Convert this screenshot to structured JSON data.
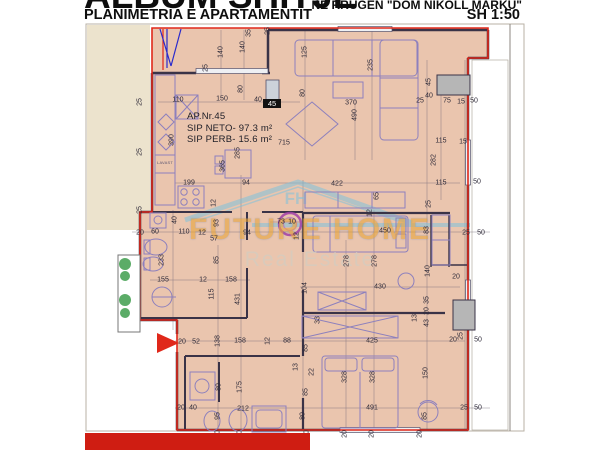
{
  "header": {
    "title": "ALBUM SHITJE",
    "subtitle": "PLANIMETRIA E APARTAMENTIT",
    "address": "NE RRUGEN \"DOM NIKOLL MARKU\"",
    "scale": "SH 1:50"
  },
  "apartment": {
    "number_label": "AP.Nr.45",
    "net_area": "SIP NETO- 97.3 m²",
    "common_area": "SIP PERB- 15.6 m²",
    "unit_marker": "45",
    "kitchen_appliance_label": "LAVAST"
  },
  "watermark": {
    "brand": "FUTURE HOME",
    "tagline": "Real Estate",
    "initials": "FH"
  },
  "colors": {
    "boundary_red": "#e0281a",
    "floor_peach": "#eac5ae",
    "exterior_cream": "#ece3cd",
    "wall_dark": "#3a3347",
    "furniture_purple": "#8d80bd",
    "watermark_orange": "#e8a43c",
    "watermark_blue": "#7fc2dc",
    "plant_green": "#3f9e4d",
    "accent_gray": "#b6b6b6",
    "bottom_bar_red": "#cf1d12"
  },
  "dimensions": [
    {
      "t": "140",
      "x": 221,
      "y": 52,
      "r": 1
    },
    {
      "t": "140",
      "x": 243,
      "y": 47,
      "r": 1
    },
    {
      "t": "35",
      "x": 249,
      "y": 33,
      "r": 1
    },
    {
      "t": "25",
      "x": 206,
      "y": 68,
      "r": 1
    },
    {
      "t": "80",
      "x": 241,
      "y": 89,
      "r": 1
    },
    {
      "t": "110",
      "x": 178,
      "y": 100,
      "r": 0
    },
    {
      "t": "150",
      "x": 222,
      "y": 99,
      "r": 0
    },
    {
      "t": "40",
      "x": 258,
      "y": 100,
      "r": 0
    },
    {
      "t": "370",
      "x": 351,
      "y": 103,
      "r": 0
    },
    {
      "t": "490",
      "x": 355,
      "y": 115,
      "r": 1
    },
    {
      "t": "25",
      "x": 268,
      "y": 31,
      "r": 1
    },
    {
      "t": "125",
      "x": 305,
      "y": 52,
      "r": 1
    },
    {
      "t": "80",
      "x": 303,
      "y": 93,
      "r": 1
    },
    {
      "t": "235",
      "x": 371,
      "y": 65,
      "r": 1
    },
    {
      "t": "25",
      "x": 420,
      "y": 101,
      "r": 0
    },
    {
      "t": "40",
      "x": 429,
      "y": 96,
      "r": 0
    },
    {
      "t": "45",
      "x": 429,
      "y": 82,
      "r": 1
    },
    {
      "t": "75",
      "x": 447,
      "y": 101,
      "r": 0
    },
    {
      "t": "15",
      "x": 461,
      "y": 102,
      "r": 0
    },
    {
      "t": "50",
      "x": 474,
      "y": 101,
      "r": 0
    },
    {
      "t": "115",
      "x": 441,
      "y": 141,
      "r": 0
    },
    {
      "t": "15",
      "x": 463,
      "y": 142,
      "r": 0
    },
    {
      "t": "282",
      "x": 434,
      "y": 160,
      "r": 1
    },
    {
      "t": "115",
      "x": 441,
      "y": 183,
      "r": 0
    },
    {
      "t": "50",
      "x": 477,
      "y": 182,
      "r": 0
    },
    {
      "t": "390",
      "x": 172,
      "y": 140,
      "r": 1
    },
    {
      "t": "285",
      "x": 238,
      "y": 153,
      "r": 1
    },
    {
      "t": "365",
      "x": 223,
      "y": 166,
      "r": 1
    },
    {
      "t": "199",
      "x": 189,
      "y": 183,
      "r": 0
    },
    {
      "t": "94",
      "x": 246,
      "y": 183,
      "r": 0
    },
    {
      "t": "422",
      "x": 337,
      "y": 184,
      "r": 0
    },
    {
      "t": "65",
      "x": 377,
      "y": 196,
      "r": 1
    },
    {
      "t": "25",
      "x": 429,
      "y": 204,
      "r": 1
    },
    {
      "t": "12",
      "x": 214,
      "y": 203,
      "r": 1
    },
    {
      "t": "12",
      "x": 370,
      "y": 213,
      "r": 1
    },
    {
      "t": "93",
      "x": 217,
      "y": 223,
      "r": 1
    },
    {
      "t": "40",
      "x": 175,
      "y": 220,
      "r": 1
    },
    {
      "t": "20",
      "x": 140,
      "y": 233,
      "r": 0
    },
    {
      "t": "60",
      "x": 155,
      "y": 232,
      "r": 0
    },
    {
      "t": "110",
      "x": 184,
      "y": 232,
      "r": 0
    },
    {
      "t": "12",
      "x": 202,
      "y": 233,
      "r": 0
    },
    {
      "t": "57",
      "x": 214,
      "y": 239,
      "r": 0
    },
    {
      "t": "94",
      "x": 247,
      "y": 233,
      "r": 0
    },
    {
      "t": "73",
      "x": 281,
      "y": 222,
      "r": 0
    },
    {
      "t": "10",
      "x": 292,
      "y": 222,
      "r": 0
    },
    {
      "t": "12",
      "x": 297,
      "y": 236,
      "r": 1
    },
    {
      "t": "450",
      "x": 385,
      "y": 231,
      "r": 0
    },
    {
      "t": "83",
      "x": 427,
      "y": 230,
      "r": 1
    },
    {
      "t": "25",
      "x": 466,
      "y": 233,
      "r": 0
    },
    {
      "t": "50",
      "x": 481,
      "y": 233,
      "r": 0
    },
    {
      "t": "278",
      "x": 347,
      "y": 261,
      "r": 1
    },
    {
      "t": "278",
      "x": 375,
      "y": 261,
      "r": 1
    },
    {
      "t": "140",
      "x": 428,
      "y": 271,
      "r": 1
    },
    {
      "t": "104",
      "x": 305,
      "y": 288,
      "r": 1
    },
    {
      "t": "430",
      "x": 380,
      "y": 287,
      "r": 0
    },
    {
      "t": "20",
      "x": 456,
      "y": 277,
      "r": 0
    },
    {
      "t": "35",
      "x": 427,
      "y": 300,
      "r": 1
    },
    {
      "t": "20",
      "x": 427,
      "y": 311,
      "r": 1
    },
    {
      "t": "233",
      "x": 162,
      "y": 260,
      "r": 1
    },
    {
      "t": "85",
      "x": 217,
      "y": 260,
      "r": 1
    },
    {
      "t": "155",
      "x": 163,
      "y": 280,
      "r": 0
    },
    {
      "t": "12",
      "x": 203,
      "y": 280,
      "r": 0
    },
    {
      "t": "158",
      "x": 231,
      "y": 280,
      "r": 0
    },
    {
      "t": "115",
      "x": 212,
      "y": 294,
      "r": 1
    },
    {
      "t": "431",
      "x": 238,
      "y": 299,
      "r": 1
    },
    {
      "t": "33",
      "x": 318,
      "y": 320,
      "r": 1
    },
    {
      "t": "13",
      "x": 415,
      "y": 318,
      "r": 1
    },
    {
      "t": "43",
      "x": 427,
      "y": 323,
      "r": 1
    },
    {
      "t": "425",
      "x": 372,
      "y": 341,
      "r": 0
    },
    {
      "t": "20",
      "x": 453,
      "y": 340,
      "r": 0
    },
    {
      "t": "25",
      "x": 461,
      "y": 336,
      "r": 1
    },
    {
      "t": "50",
      "x": 478,
      "y": 340,
      "r": 0
    },
    {
      "t": "20",
      "x": 182,
      "y": 342,
      "r": 0
    },
    {
      "t": "52",
      "x": 196,
      "y": 342,
      "r": 0
    },
    {
      "t": "138",
      "x": 218,
      "y": 341,
      "r": 1
    },
    {
      "t": "158",
      "x": 240,
      "y": 341,
      "r": 0
    },
    {
      "t": "12",
      "x": 268,
      "y": 341,
      "r": 1
    },
    {
      "t": "88",
      "x": 287,
      "y": 341,
      "r": 0
    },
    {
      "t": "85",
      "x": 306,
      "y": 348,
      "r": 1
    },
    {
      "t": "13",
      "x": 296,
      "y": 367,
      "r": 1
    },
    {
      "t": "22",
      "x": 312,
      "y": 372,
      "r": 1
    },
    {
      "t": "80",
      "x": 219,
      "y": 387,
      "r": 1
    },
    {
      "t": "175",
      "x": 240,
      "y": 387,
      "r": 1
    },
    {
      "t": "328",
      "x": 345,
      "y": 377,
      "r": 1
    },
    {
      "t": "328",
      "x": 373,
      "y": 377,
      "r": 1
    },
    {
      "t": "150",
      "x": 426,
      "y": 373,
      "r": 1
    },
    {
      "t": "85",
      "x": 306,
      "y": 392,
      "r": 1
    },
    {
      "t": "20",
      "x": 181,
      "y": 408,
      "r": 0
    },
    {
      "t": "40",
      "x": 193,
      "y": 408,
      "r": 0
    },
    {
      "t": "212",
      "x": 243,
      "y": 409,
      "r": 0
    },
    {
      "t": "95",
      "x": 218,
      "y": 416,
      "r": 1
    },
    {
      "t": "80",
      "x": 303,
      "y": 416,
      "r": 1
    },
    {
      "t": "491",
      "x": 372,
      "y": 408,
      "r": 0
    },
    {
      "t": "85",
      "x": 425,
      "y": 416,
      "r": 1
    },
    {
      "t": "25",
      "x": 464,
      "y": 408,
      "r": 0
    },
    {
      "t": "50",
      "x": 478,
      "y": 408,
      "r": 0
    },
    {
      "t": "20",
      "x": 218,
      "y": 434,
      "r": 1
    },
    {
      "t": "20",
      "x": 240,
      "y": 434,
      "r": 1
    },
    {
      "t": "20",
      "x": 307,
      "y": 434,
      "r": 1
    },
    {
      "t": "20",
      "x": 345,
      "y": 434,
      "r": 1
    },
    {
      "t": "20",
      "x": 372,
      "y": 434,
      "r": 1
    },
    {
      "t": "20",
      "x": 420,
      "y": 434,
      "r": 1
    },
    {
      "t": "25",
      "x": 140,
      "y": 102,
      "r": 1
    },
    {
      "t": "25",
      "x": 140,
      "y": 152,
      "r": 1
    },
    {
      "t": "25",
      "x": 140,
      "y": 210,
      "r": 1
    },
    {
      "t": "715",
      "x": 284,
      "y": 143,
      "r": 0
    }
  ]
}
